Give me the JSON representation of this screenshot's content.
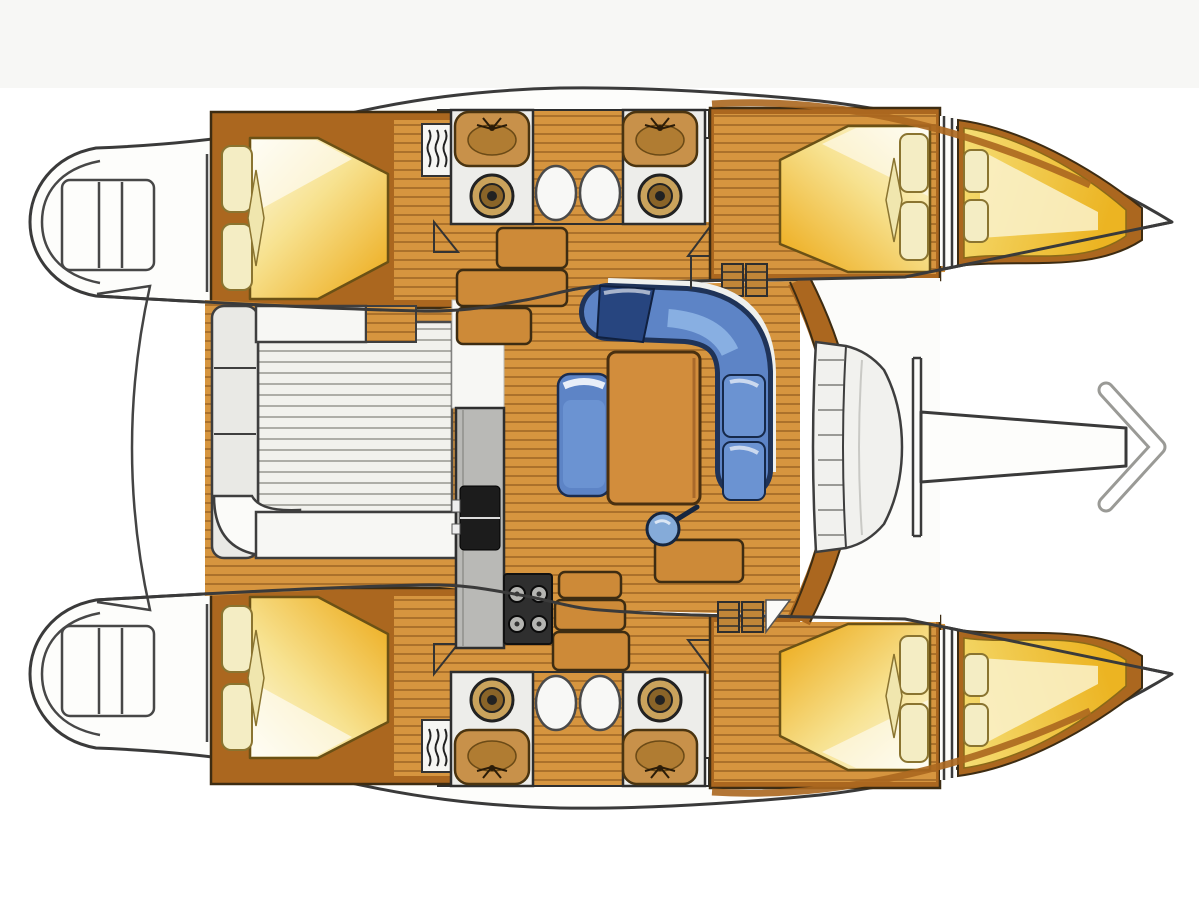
{
  "meta": {
    "title": "Catamaran interior layout plan (top view)",
    "type": "boat-floor-plan",
    "text_labels": []
  },
  "legend": {
    "areas": [
      "port hull",
      "starboard hull",
      "aft double-berth cabin (port)",
      "aft double-berth cabin (starboard)",
      "forward double-berth cabin (port)",
      "forward double-berth cabin (starboard)",
      "bow V-berth (port)",
      "bow V-berth (starboard)",
      "head compartment with sink and toilet (port)",
      "head compartment with sink and toilet (starboard)",
      "shower trays",
      "hull corridor with companionway steps",
      "saloon with L-shaped sofa, table, seat and stool",
      "galley counter with sink and 4-burner stove",
      "cockpit with slatted floor and bench cushions",
      "stern swim platform (port)",
      "stern swim platform (starboard)",
      "forward curved bench",
      "boarding / direction arrow"
    ]
  },
  "colors": {
    "page_bg": "#ffffff",
    "top_band": "#f7f7f5",
    "hull_white": "#fdfdfb",
    "outline": "#3a3a3a",
    "wood": "#d6953f",
    "wood_line": "#9c6524",
    "trim": "#ab671f",
    "trim_edge": "#3d2c12",
    "bed_yellow": "#f0c133",
    "bed_cream": "#fdfae8",
    "pillow": "#f4edc4",
    "pillow_edge": "#8a7430",
    "sofa": "#5d84c6",
    "sofa_dark": "#1f3358",
    "sofa_light": "#8fb6e6",
    "table_wood": "#d28d3c",
    "stool_blue": "#85abd9",
    "galley_gray": "#b9b9b6",
    "stove_dark": "#2f2f2f",
    "burner_gray": "#b5b5b2",
    "sink_black": "#1c1c1c",
    "head_floor": "#ededea",
    "sink_tan": "#c8914a",
    "toilet_tan": "#caa35c",
    "cushion_white": "#f7f7f4",
    "slat_floor": "#f1f1ed",
    "slat_line": "#a5a5a0",
    "arrow_fill": "#fdfdfb"
  }
}
